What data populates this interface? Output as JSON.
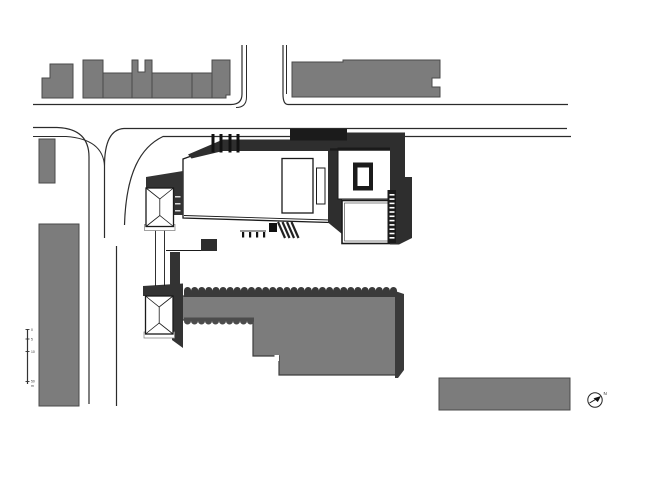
{
  "title": "architectural site plan",
  "colors": {
    "bg": "#ffffff",
    "white": "#ffffff",
    "building_gray": "#7c7c7c",
    "building_outline": "#4a4a4a",
    "south_outline": "#3d3d3d",
    "shadow": "#333333",
    "band": "#2e2e2e",
    "band_darkest": "#1b1b1b",
    "scallop_top": "#3a3a3a",
    "scallop_bottom": "#4c4c4c",
    "ink": "#1a1a1a",
    "street": "#2b2b2b"
  },
  "scale_bar": {
    "labels": [
      "0",
      "5",
      "10",
      "50"
    ],
    "unit": "m"
  },
  "north_arrow": {
    "label": "N"
  }
}
